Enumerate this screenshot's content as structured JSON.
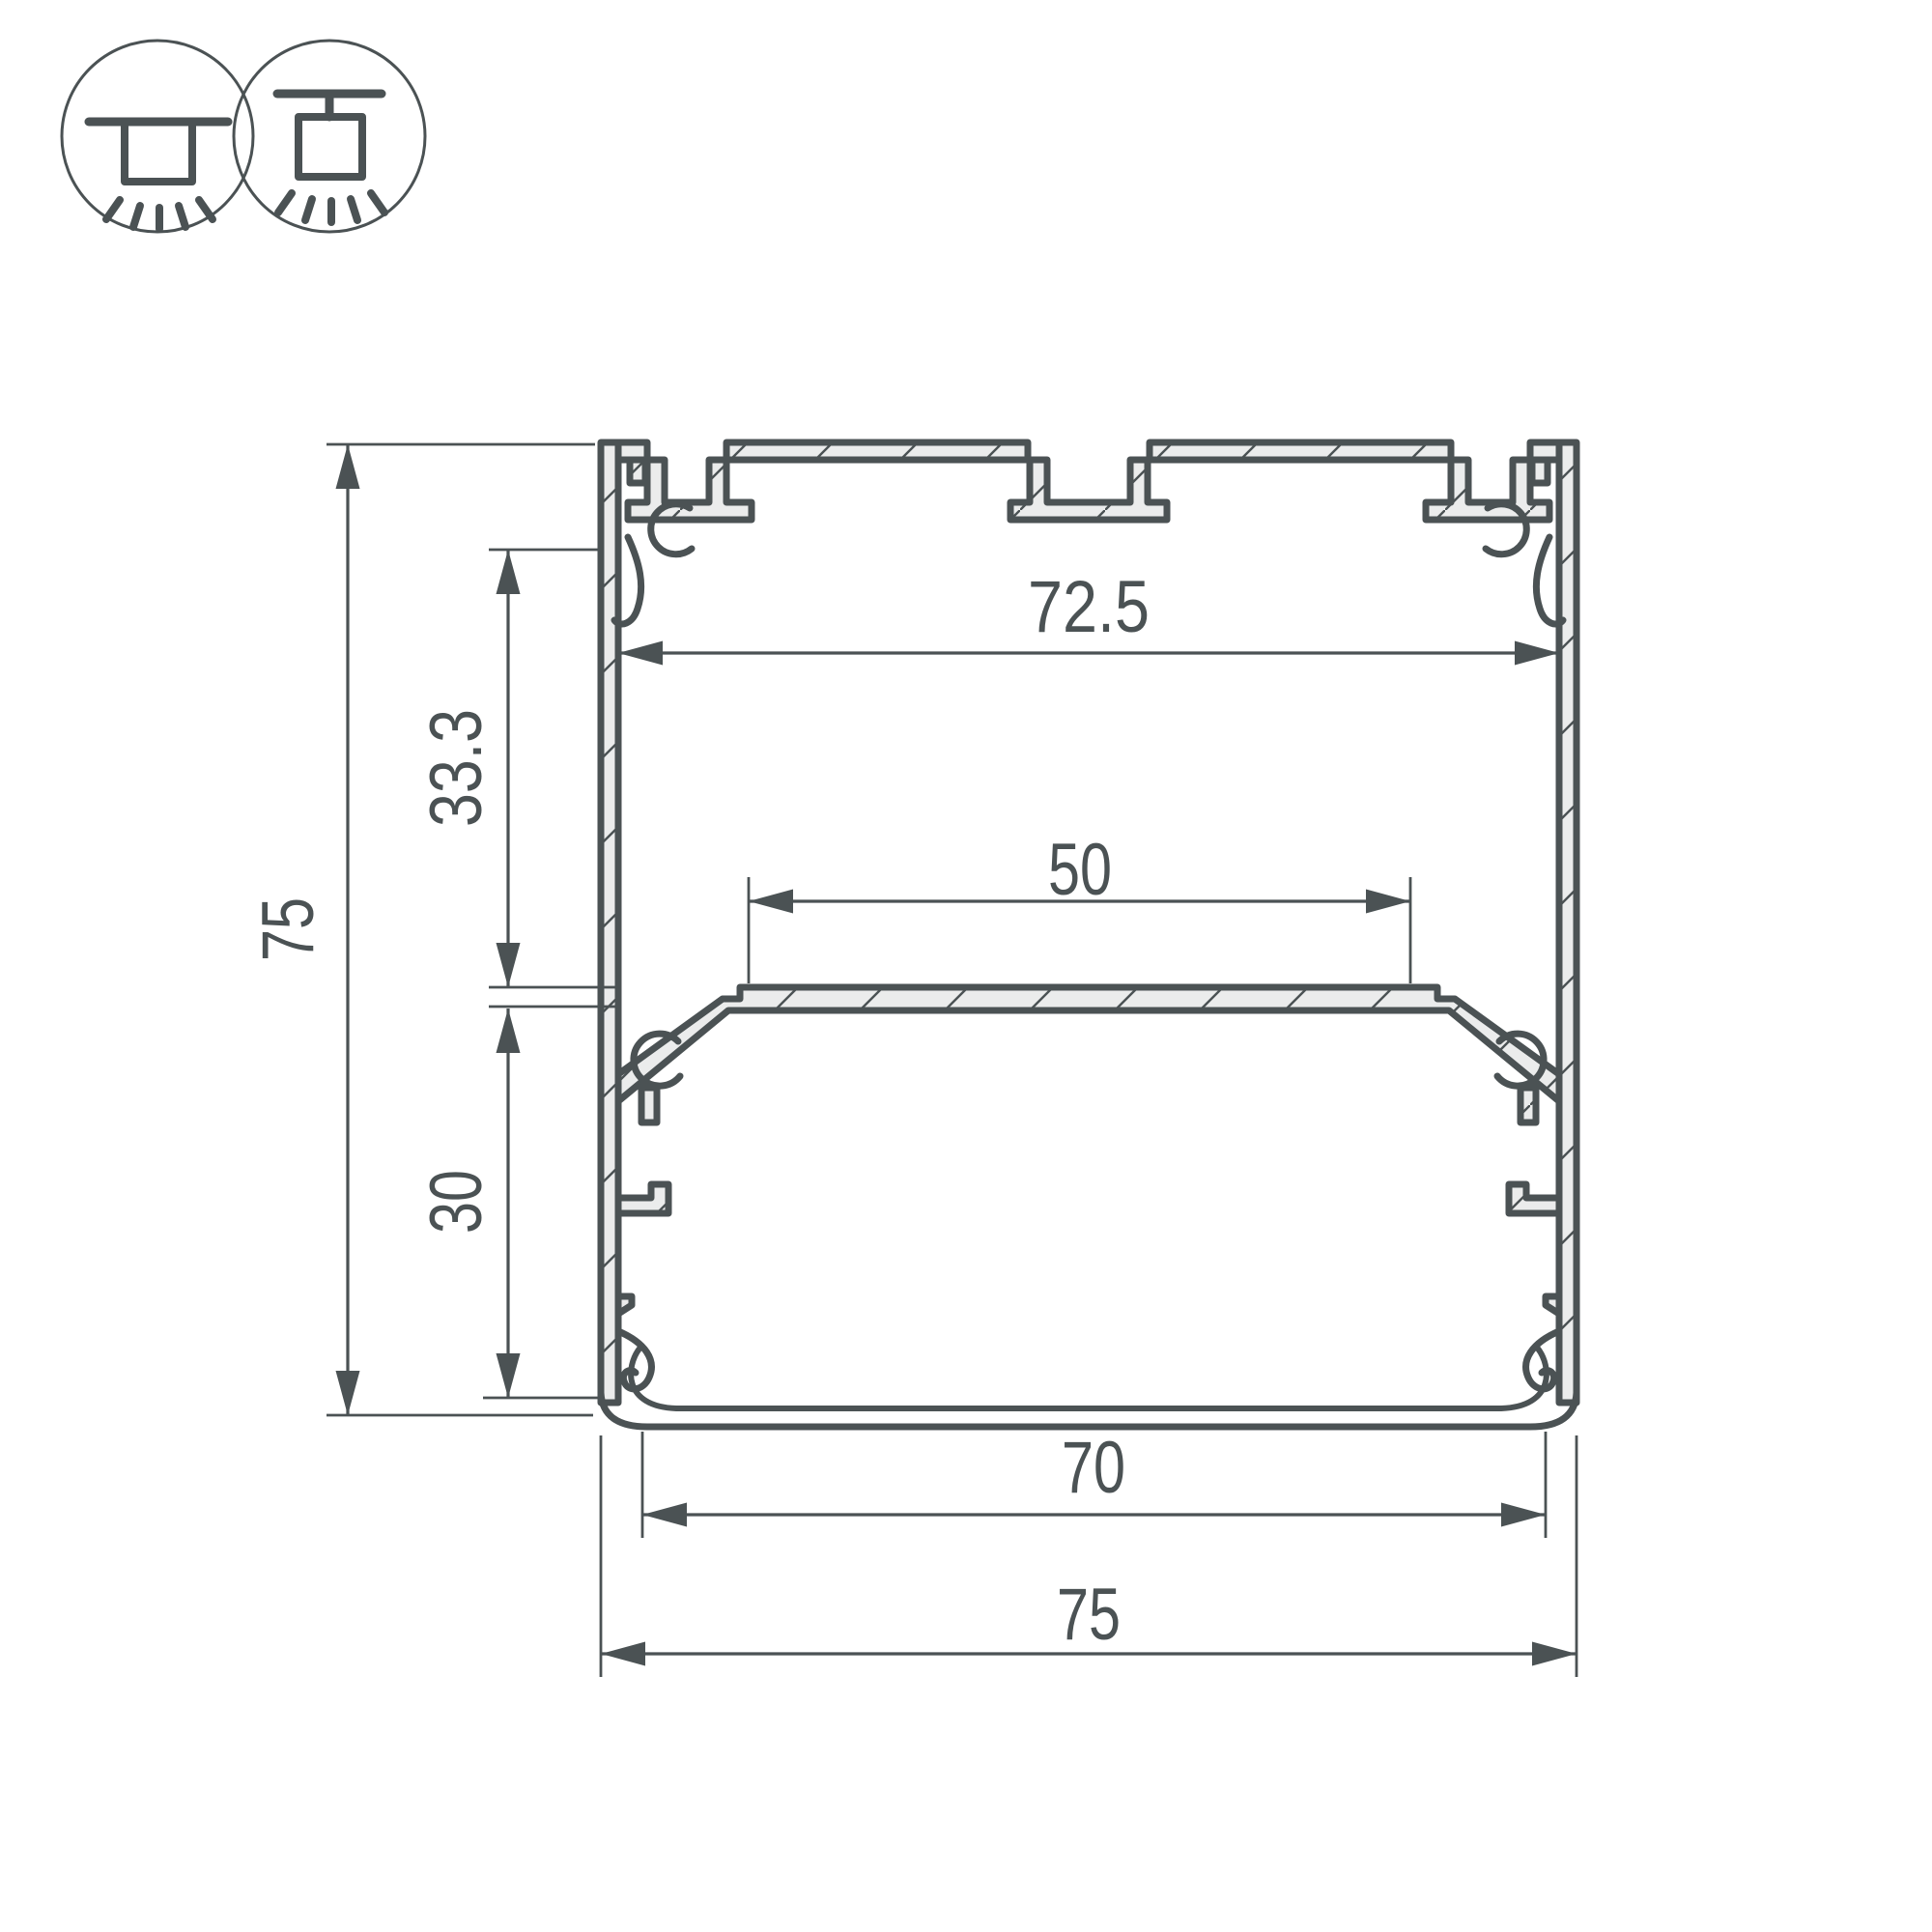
{
  "drawing": {
    "type": "led-profile-cross-section",
    "dimensions": {
      "overall_height": "75",
      "inner_width": "72.5",
      "upper_depth": "33.3",
      "led_shelf_width": "50",
      "lower_depth": "30",
      "diffuser_width": "70",
      "overall_width": "75"
    },
    "mount_icons": [
      "surface-mount-icon",
      "suspension-mount-icon"
    ],
    "colors": {
      "line": "#4b5254",
      "material_fill": "#ebecec",
      "background": "#ffffff"
    }
  }
}
